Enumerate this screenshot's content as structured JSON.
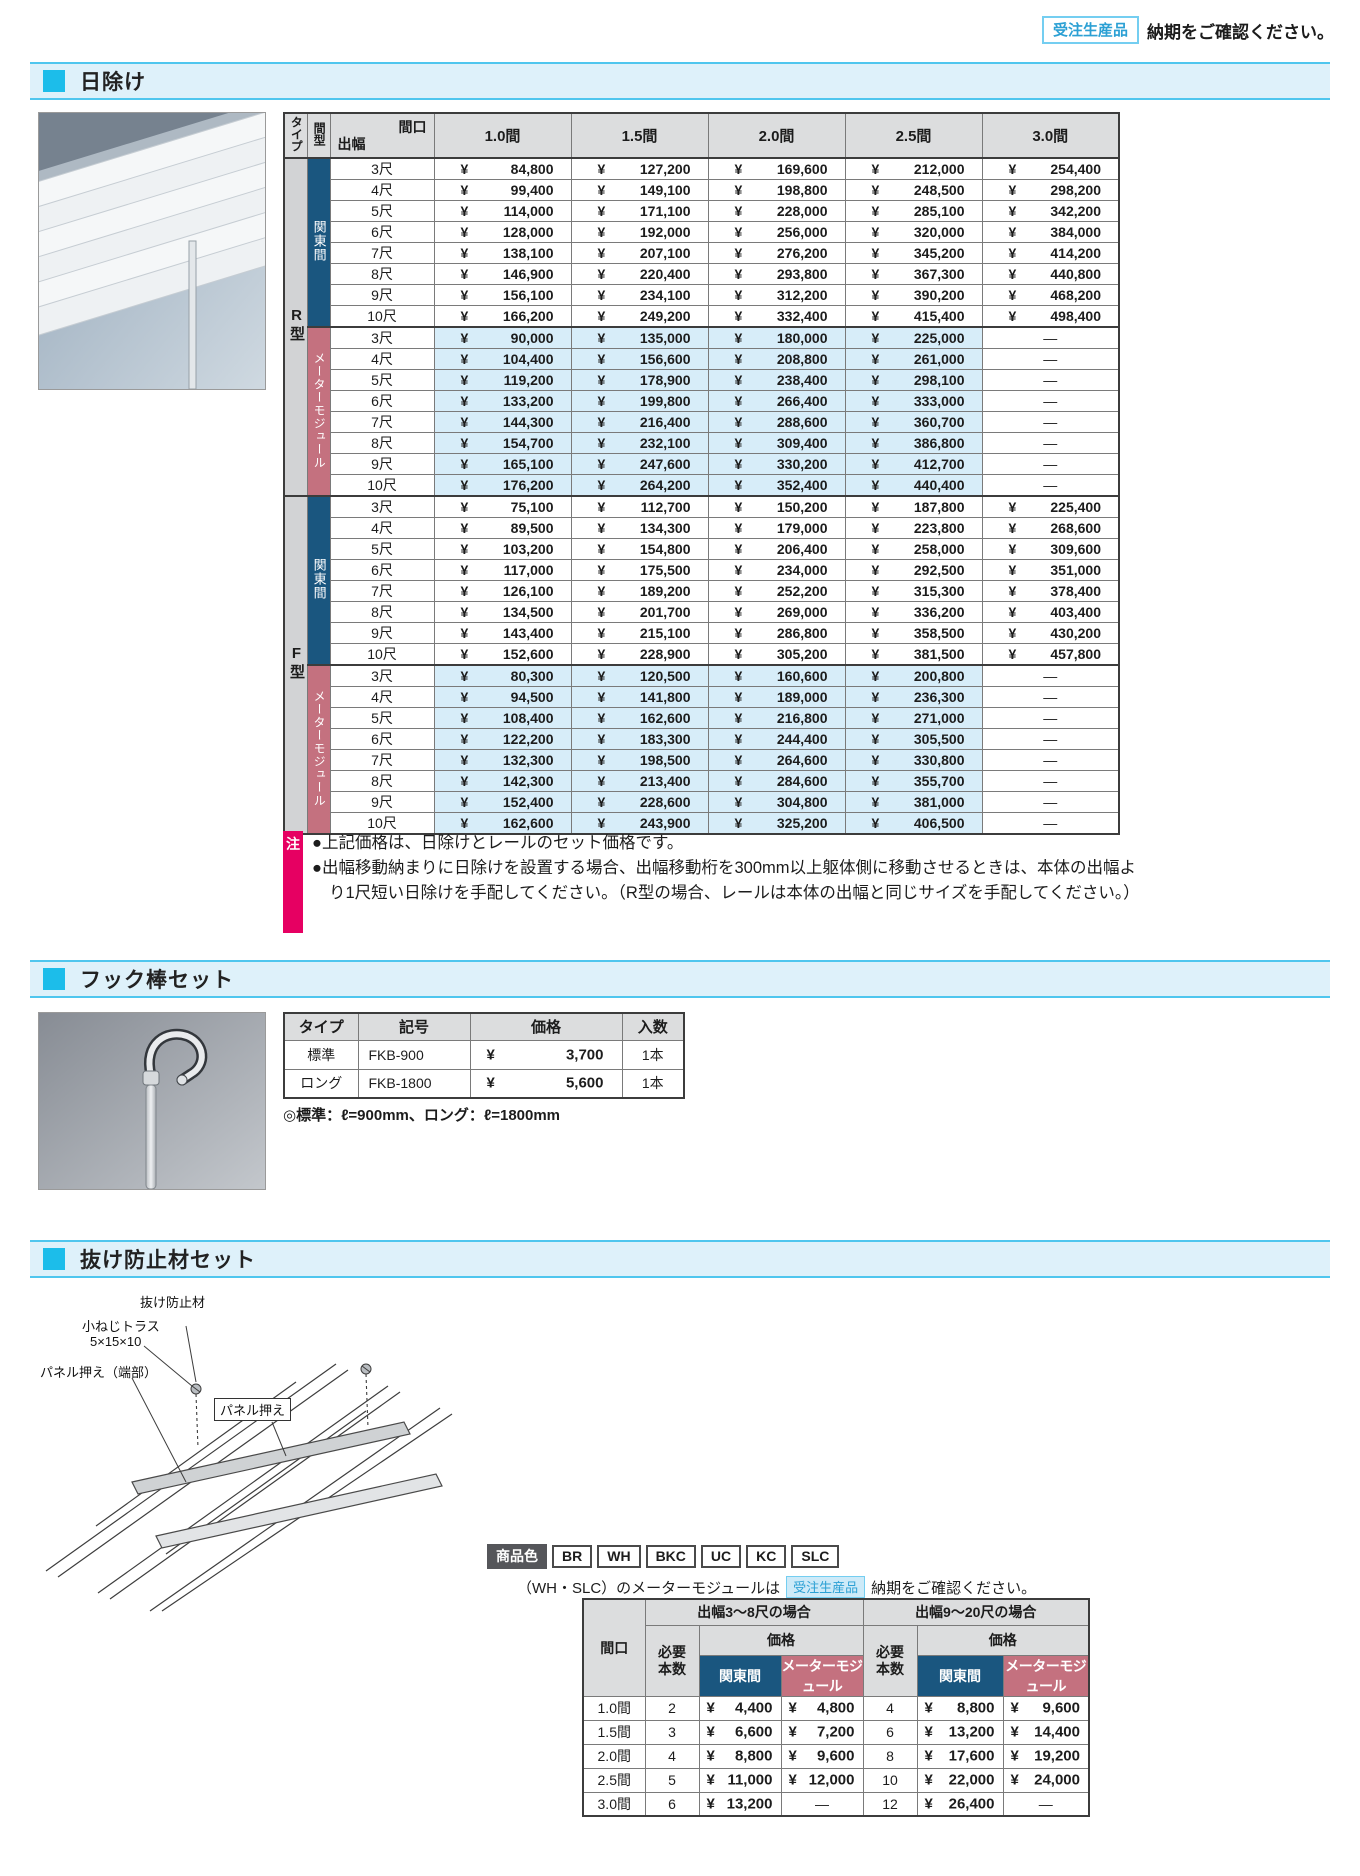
{
  "top_note": {
    "badge": "受注生産品",
    "text": "納期をご確認ください。"
  },
  "sections": {
    "hiyoke": "日除け",
    "hook": "フック棒セット",
    "nuke": "抜け防止材セット"
  },
  "price_table": {
    "type_label": "タイプ",
    "span_label": "間型",
    "corner_top": "間口",
    "corner_left": "出幅",
    "col_headers": [
      "1.0間",
      "1.5間",
      "2.0間",
      "2.5間",
      "3.0間"
    ],
    "groups": [
      {
        "type": "R型",
        "span": "関東間",
        "style": "kanto",
        "rows": [
          {
            "depth": "3尺",
            "prices": [
              "84,800",
              "127,200",
              "169,600",
              "212,000",
              "254,400"
            ]
          },
          {
            "depth": "4尺",
            "prices": [
              "99,400",
              "149,100",
              "198,800",
              "248,500",
              "298,200"
            ]
          },
          {
            "depth": "5尺",
            "prices": [
              "114,000",
              "171,100",
              "228,000",
              "285,100",
              "342,200"
            ]
          },
          {
            "depth": "6尺",
            "prices": [
              "128,000",
              "192,000",
              "256,000",
              "320,000",
              "384,000"
            ]
          },
          {
            "depth": "7尺",
            "prices": [
              "138,100",
              "207,100",
              "276,200",
              "345,200",
              "414,200"
            ]
          },
          {
            "depth": "8尺",
            "prices": [
              "146,900",
              "220,400",
              "293,800",
              "367,300",
              "440,800"
            ]
          },
          {
            "depth": "9尺",
            "prices": [
              "156,100",
              "234,100",
              "312,200",
              "390,200",
              "468,200"
            ]
          },
          {
            "depth": "10尺",
            "prices": [
              "166,200",
              "249,200",
              "332,400",
              "415,400",
              "498,400"
            ]
          }
        ]
      },
      {
        "type": "R型",
        "span": "メーターモジュール",
        "style": "meter",
        "rows": [
          {
            "depth": "3尺",
            "prices": [
              "90,000",
              "135,000",
              "180,000",
              "225,000",
              "—"
            ]
          },
          {
            "depth": "4尺",
            "prices": [
              "104,400",
              "156,600",
              "208,800",
              "261,000",
              "—"
            ]
          },
          {
            "depth": "5尺",
            "prices": [
              "119,200",
              "178,900",
              "238,400",
              "298,100",
              "—"
            ]
          },
          {
            "depth": "6尺",
            "prices": [
              "133,200",
              "199,800",
              "266,400",
              "333,000",
              "—"
            ]
          },
          {
            "depth": "7尺",
            "prices": [
              "144,300",
              "216,400",
              "288,600",
              "360,700",
              "—"
            ]
          },
          {
            "depth": "8尺",
            "prices": [
              "154,700",
              "232,100",
              "309,400",
              "386,800",
              "—"
            ]
          },
          {
            "depth": "9尺",
            "prices": [
              "165,100",
              "247,600",
              "330,200",
              "412,700",
              "—"
            ]
          },
          {
            "depth": "10尺",
            "prices": [
              "176,200",
              "264,200",
              "352,400",
              "440,400",
              "—"
            ]
          }
        ]
      },
      {
        "type": "F型",
        "span": "関東間",
        "style": "kanto",
        "rows": [
          {
            "depth": "3尺",
            "prices": [
              "75,100",
              "112,700",
              "150,200",
              "187,800",
              "225,400"
            ]
          },
          {
            "depth": "4尺",
            "prices": [
              "89,500",
              "134,300",
              "179,000",
              "223,800",
              "268,600"
            ]
          },
          {
            "depth": "5尺",
            "prices": [
              "103,200",
              "154,800",
              "206,400",
              "258,000",
              "309,600"
            ]
          },
          {
            "depth": "6尺",
            "prices": [
              "117,000",
              "175,500",
              "234,000",
              "292,500",
              "351,000"
            ]
          },
          {
            "depth": "7尺",
            "prices": [
              "126,100",
              "189,200",
              "252,200",
              "315,300",
              "378,400"
            ]
          },
          {
            "depth": "8尺",
            "prices": [
              "134,500",
              "201,700",
              "269,000",
              "336,200",
              "403,400"
            ]
          },
          {
            "depth": "9尺",
            "prices": [
              "143,400",
              "215,100",
              "286,800",
              "358,500",
              "430,200"
            ]
          },
          {
            "depth": "10尺",
            "prices": [
              "152,600",
              "228,900",
              "305,200",
              "381,500",
              "457,800"
            ]
          }
        ]
      },
      {
        "type": "F型",
        "span": "メーターモジュール",
        "style": "meter",
        "rows": [
          {
            "depth": "3尺",
            "prices": [
              "80,300",
              "120,500",
              "160,600",
              "200,800",
              "—"
            ]
          },
          {
            "depth": "4尺",
            "prices": [
              "94,500",
              "141,800",
              "189,000",
              "236,300",
              "—"
            ]
          },
          {
            "depth": "5尺",
            "prices": [
              "108,400",
              "162,600",
              "216,800",
              "271,000",
              "—"
            ]
          },
          {
            "depth": "6尺",
            "prices": [
              "122,200",
              "183,300",
              "244,400",
              "305,500",
              "—"
            ]
          },
          {
            "depth": "7尺",
            "prices": [
              "132,300",
              "198,500",
              "264,600",
              "330,800",
              "—"
            ]
          },
          {
            "depth": "8尺",
            "prices": [
              "142,300",
              "213,400",
              "284,600",
              "355,700",
              "—"
            ]
          },
          {
            "depth": "9尺",
            "prices": [
              "152,400",
              "228,600",
              "304,800",
              "381,000",
              "—"
            ]
          },
          {
            "depth": "10尺",
            "prices": [
              "162,600",
              "243,900",
              "325,200",
              "406,500",
              "—"
            ]
          }
        ]
      }
    ]
  },
  "note": {
    "label": "注",
    "lines": [
      "●上記価格は、日除けとレールのセット価格です。",
      "●出幅移動納まりに日除けを設置する場合、出幅移動桁を300mm以上躯体側に移動させるときは、本体の出幅より1尺短い日除けを手配してください。（R型の場合、レールは本体の出幅と同じサイズを手配してください。）"
    ]
  },
  "hook": {
    "headers": [
      "タイプ",
      "記号",
      "価格",
      "入数"
    ],
    "rows": [
      {
        "type": "標準",
        "code": "FKB-900",
        "price": "3,700",
        "qty": "1本"
      },
      {
        "type": "ロング",
        "code": "FKB-1800",
        "price": "5,600",
        "qty": "1本"
      }
    ],
    "note": "◎標準：ℓ=900mm、ロング：ℓ=1800mm"
  },
  "nuke": {
    "color_label": "商品色",
    "colors": [
      "BR",
      "WH",
      "BKC",
      "UC",
      "KC",
      "SLC"
    ],
    "order_note_pre": "（WH・SLC）のメーターモジュールは",
    "order_note_badge": "受注生産品",
    "order_note_post": "納期をご確認ください。",
    "diagram_labels": {
      "nuke": "抜け防止材",
      "screw1": "小ねじトラス",
      "screw2": "5×15×10",
      "panel_edge": "パネル押え（端部）",
      "panel": "パネル押え"
    },
    "table": {
      "maguchi_label": "間口",
      "group_headers": [
        "出幅3～8尺の場合",
        "出幅9～20尺の場合"
      ],
      "count_label": "必要\n本数",
      "price_label": "価格",
      "kanto_label": "関東間",
      "meter_label": "メーターモジュール",
      "rows": [
        {
          "maguchi": "1.0間",
          "count1": "2",
          "kanto1": "4,400",
          "meter1": "4,800",
          "count2": "4",
          "kanto2": "8,800",
          "meter2": "9,600"
        },
        {
          "maguchi": "1.5間",
          "count1": "3",
          "kanto1": "6,600",
          "meter1": "7,200",
          "count2": "6",
          "kanto2": "13,200",
          "meter2": "14,400"
        },
        {
          "maguchi": "2.0間",
          "count1": "4",
          "kanto1": "8,800",
          "meter1": "9,600",
          "count2": "8",
          "kanto2": "17,600",
          "meter2": "19,200"
        },
        {
          "maguchi": "2.5間",
          "count1": "5",
          "kanto1": "11,000",
          "meter1": "12,000",
          "count2": "10",
          "kanto2": "22,000",
          "meter2": "24,000"
        },
        {
          "maguchi": "3.0間",
          "count1": "6",
          "kanto1": "13,200",
          "meter1": "—",
          "count2": "12",
          "kanto2": "26,400",
          "meter2": "—"
        }
      ]
    }
  },
  "colors": {
    "accent_cyan": "#1cbdea",
    "bar_bg": "#def1fa",
    "bar_border": "#4fc6ee",
    "kanto_blue": "#1a567f",
    "meter_pink": "#c4717f",
    "row_blue": "#d7edf9",
    "note_pink": "#e60062",
    "badge_blue": "#2ba0d4"
  }
}
